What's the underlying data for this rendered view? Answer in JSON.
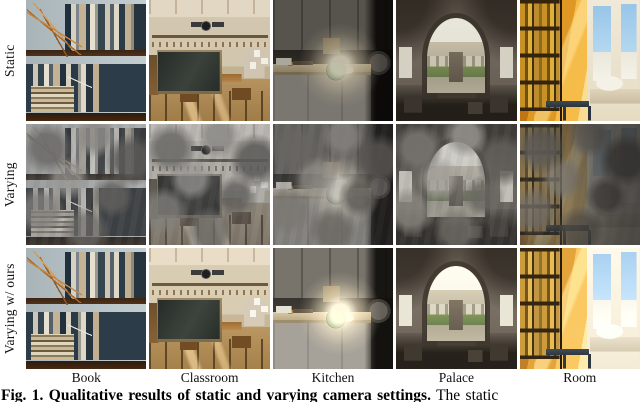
{
  "figure": {
    "row_labels": [
      "Static",
      "Varying",
      "Varying w/ ours"
    ],
    "column_labels": [
      "Book",
      "Classroom",
      "Kitchen",
      "Palace",
      "Room"
    ],
    "caption_bold": "Fig. 1. Qualitative results of static and varying camera settings.",
    "caption_rest": "The static",
    "colors": {
      "page_background": "#ffffff",
      "kettle_green": "#2e8b3a",
      "room_sunlight_amber": "#e8a93c",
      "blackboard_dark": "#2e342f",
      "artifact_gray": "#8a847a"
    }
  }
}
